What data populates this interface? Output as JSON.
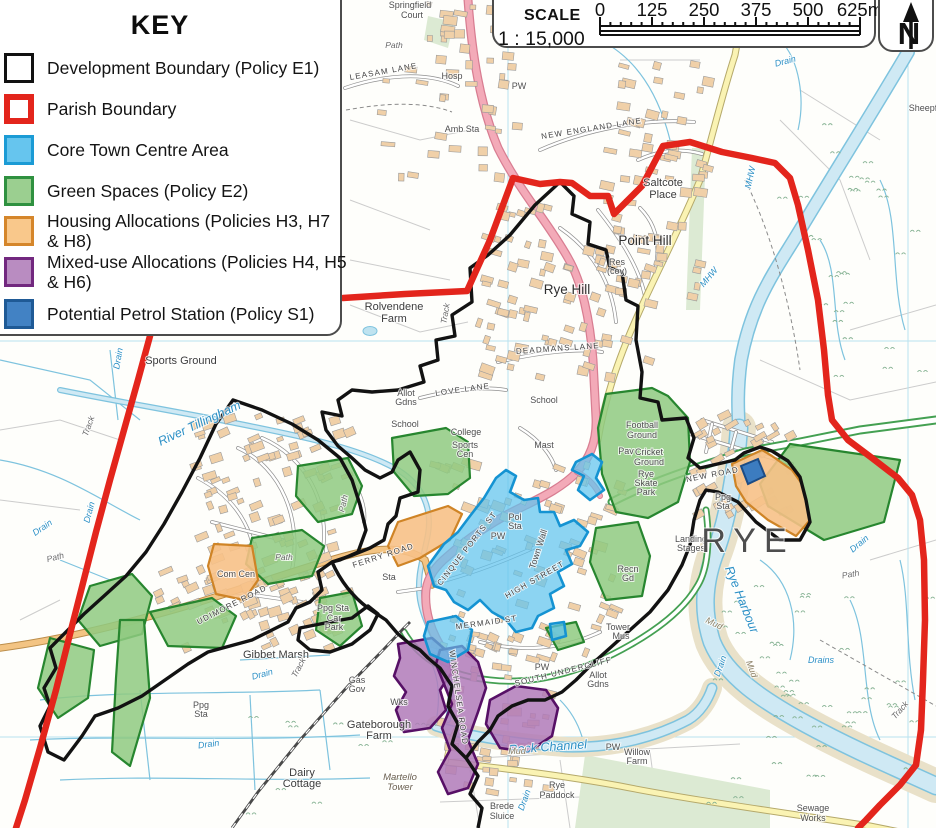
{
  "legend": {
    "title": "KEY",
    "items": [
      {
        "label": "Development Boundary (Policy E1)",
        "fill": "#ffffff",
        "stroke": "#111111",
        "border": 3
      },
      {
        "label": "Parish Boundary",
        "fill": "#ffffff",
        "stroke": "#e3251c",
        "border": 6
      },
      {
        "label": "Core Town Centre Area",
        "fill": "#66c5ee",
        "stroke": "#1b9bd5",
        "border": 3
      },
      {
        "label": "Green Spaces (Policy E2)",
        "fill": "#9bcf90",
        "stroke": "#2f9140",
        "border": 3
      },
      {
        "label": "Housing Allocations (Policies H3, H7\n& H8)",
        "fill": "#f9c88b",
        "stroke": "#d5862b",
        "border": 3
      },
      {
        "label": "Mixed-use Allocations (Policies H4, H5\n& H6)",
        "fill": "#b98cc1",
        "stroke": "#72287f",
        "border": 3
      },
      {
        "label": "Potential Petrol Station (Policy S1)",
        "fill": "#4282c4",
        "stroke": "#1f5a96",
        "border": 3
      }
    ]
  },
  "scale": {
    "label": "SCALE",
    "ratio": "1 : 15,000",
    "unit_labels": [
      "0",
      "125",
      "250",
      "375",
      "500",
      "625m"
    ]
  },
  "north": {
    "label": "N"
  },
  "colors": {
    "development_boundary": "#121212",
    "parish_boundary": "#e3251c",
    "core_town_fill": "#5fc3ef",
    "core_town_stroke": "#1593d2",
    "green_fill": "#8fca80",
    "green_stroke": "#27862f",
    "housing_fill": "#f7c187",
    "housing_stroke": "#cf8426",
    "mixed_fill": "#b07ab8",
    "mixed_stroke": "#571066",
    "petrol_fill": "#3c7cc0",
    "petrol_stroke": "#1c4c85",
    "road_primary": "#f3aab8",
    "road_primary_casing": "#d87d91",
    "road_a": "#f3c483",
    "road_a_casing": "#bb8d4a",
    "road_yellow": "#faf3b3",
    "road_yellow_casing": "#b5a96b",
    "road_minor_casing": "#8f8f8f",
    "water_line": "#7ec3de",
    "water_fill": "#cfe9f4",
    "mud": "#e9e1c9",
    "building_fill": "#f0d0a8",
    "building_stroke": "#9b9b9b",
    "grid_line": "#b8e2ef",
    "field_line": "#cccccc",
    "green_tint": "#dcead3"
  },
  "map_labels": [
    {
      "t": "Springfield",
      "x": 410,
      "y": 8,
      "c": "s"
    },
    {
      "t": "Court",
      "x": 412,
      "y": 18,
      "c": "s"
    },
    {
      "t": "Path",
      "x": 394,
      "y": 48,
      "c": "pa"
    },
    {
      "t": "LEASAM LANE",
      "x": 384,
      "y": 74,
      "c": "rd",
      "r": -10
    },
    {
      "t": "Hosp",
      "x": 452,
      "y": 79,
      "c": "s"
    },
    {
      "t": "PW",
      "x": 519,
      "y": 89,
      "c": "s"
    },
    {
      "t": "Amb Sta",
      "x": 462,
      "y": 132,
      "c": "s"
    },
    {
      "t": "NEW ENGLAND LANE",
      "x": 592,
      "y": 131,
      "c": "rd",
      "r": -9
    },
    {
      "t": "Drain",
      "x": 786,
      "y": 64,
      "c": "w",
      "r": -15
    },
    {
      "t": "Sheepfold",
      "x": 929,
      "y": 111,
      "c": "s"
    },
    {
      "t": "MHW",
      "x": 753,
      "y": 178,
      "c": "w",
      "r": -78
    },
    {
      "t": "Saltcote",
      "x": 663,
      "y": 186,
      "c": "p"
    },
    {
      "t": "Place",
      "x": 663,
      "y": 198,
      "c": "p"
    },
    {
      "t": "Point Hill",
      "x": 645,
      "y": 245,
      "c": "p13"
    },
    {
      "t": "Res",
      "x": 617,
      "y": 265,
      "c": "s"
    },
    {
      "t": "(cov)",
      "x": 617,
      "y": 274,
      "c": "s"
    },
    {
      "t": "MHW",
      "x": 711,
      "y": 279,
      "c": "w",
      "r": -50
    },
    {
      "t": "Rye Hill",
      "x": 567,
      "y": 294,
      "c": "p13"
    },
    {
      "t": "Rolvendene",
      "x": 394,
      "y": 310,
      "c": "p"
    },
    {
      "t": "Farm",
      "x": 394,
      "y": 322,
      "c": "p"
    },
    {
      "t": "Track",
      "x": 448,
      "y": 314,
      "c": "pa",
      "r": -80
    },
    {
      "t": "DEADMANS LANE",
      "x": 558,
      "y": 351,
      "c": "rd",
      "r": -4
    },
    {
      "t": "Sports Ground",
      "x": 181,
      "y": 364,
      "c": "p"
    },
    {
      "t": "Drain",
      "x": 121,
      "y": 359,
      "c": "w",
      "r": -80
    },
    {
      "t": "Track",
      "x": 91,
      "y": 427,
      "c": "pa",
      "r": -70
    },
    {
      "t": "River Tillingham",
      "x": 201,
      "y": 427,
      "c": "wlg",
      "r": -25
    },
    {
      "t": "Allot",
      "x": 406,
      "y": 396,
      "c": "s"
    },
    {
      "t": "Gdns",
      "x": 406,
      "y": 405,
      "c": "s"
    },
    {
      "t": "LOVE LANE",
      "x": 463,
      "y": 392,
      "c": "rd",
      "r": -8
    },
    {
      "t": "School",
      "x": 405,
      "y": 427,
      "c": "s"
    },
    {
      "t": "School",
      "x": 544,
      "y": 403,
      "c": "s"
    },
    {
      "t": "College",
      "x": 466,
      "y": 435,
      "c": "s"
    },
    {
      "t": "Sports",
      "x": 465,
      "y": 448,
      "c": "s"
    },
    {
      "t": "Cen",
      "x": 465,
      "y": 457,
      "c": "s"
    },
    {
      "t": "Mast",
      "x": 544,
      "y": 448,
      "c": "s"
    },
    {
      "t": "Football",
      "x": 642,
      "y": 428,
      "c": "s"
    },
    {
      "t": "Ground",
      "x": 642,
      "y": 438,
      "c": "s"
    },
    {
      "t": "Pav",
      "x": 626,
      "y": 454,
      "c": "s"
    },
    {
      "t": "Cricket",
      "x": 649,
      "y": 455,
      "c": "s"
    },
    {
      "t": "Ground",
      "x": 649,
      "y": 465,
      "c": "s"
    },
    {
      "t": "Rye",
      "x": 646,
      "y": 477,
      "c": "s"
    },
    {
      "t": "Skate",
      "x": 646,
      "y": 486,
      "c": "s"
    },
    {
      "t": "Park",
      "x": 646,
      "y": 495,
      "c": "s"
    },
    {
      "t": "Drain",
      "x": 92,
      "y": 513,
      "c": "w",
      "r": -75
    },
    {
      "t": "Drain",
      "x": 44,
      "y": 530,
      "c": "w",
      "r": -35
    },
    {
      "t": "Path",
      "x": 56,
      "y": 560,
      "c": "pa",
      "r": -15
    },
    {
      "t": "Pol",
      "x": 515,
      "y": 520,
      "c": "s"
    },
    {
      "t": "Sta",
      "x": 515,
      "y": 529,
      "c": "s"
    },
    {
      "t": "PW",
      "x": 498,
      "y": 539,
      "c": "s"
    },
    {
      "t": "Town Wall",
      "x": 541,
      "y": 550,
      "c": "s",
      "r": -72
    },
    {
      "t": "Ppg",
      "x": 723,
      "y": 500,
      "c": "s"
    },
    {
      "t": "Sta",
      "x": 723,
      "y": 509,
      "c": "s"
    },
    {
      "t": "NEW ROAD",
      "x": 713,
      "y": 477,
      "c": "rd",
      "r": -11
    },
    {
      "t": "Landing",
      "x": 691,
      "y": 542,
      "c": "s"
    },
    {
      "t": "Stages",
      "x": 691,
      "y": 551,
      "c": "s"
    },
    {
      "t": "Recn",
      "x": 628,
      "y": 572,
      "c": "s"
    },
    {
      "t": "Gd",
      "x": 628,
      "y": 581,
      "c": "s"
    },
    {
      "t": "RYE",
      "x": 748,
      "y": 552,
      "c": "town"
    },
    {
      "t": "Rye Harbour",
      "x": 738,
      "y": 601,
      "c": "wlg",
      "r": 68
    },
    {
      "t": "Path",
      "x": 851,
      "y": 577,
      "c": "pa",
      "r": -10
    },
    {
      "t": "Drain",
      "x": 861,
      "y": 546,
      "c": "w",
      "r": -40
    },
    {
      "t": "HIGH STREET",
      "x": 536,
      "y": 582,
      "c": "rd",
      "r": -30
    },
    {
      "t": "CINQUE PORTS ST",
      "x": 469,
      "y": 550,
      "c": "rd",
      "r": -52
    },
    {
      "t": "FERRY ROAD",
      "x": 384,
      "y": 558,
      "c": "rd",
      "r": -18
    },
    {
      "t": "Sta",
      "x": 389,
      "y": 580,
      "c": "s"
    },
    {
      "t": "Com Cen",
      "x": 236,
      "y": 577,
      "c": "s"
    },
    {
      "t": "Path",
      "x": 284,
      "y": 560,
      "c": "pa"
    },
    {
      "t": "Path",
      "x": 346,
      "y": 504,
      "c": "pa",
      "r": -78
    },
    {
      "t": "UDIMORE ROAD",
      "x": 233,
      "y": 607,
      "c": "rd",
      "r": -27
    },
    {
      "t": "Ppg Sta",
      "x": 333,
      "y": 611,
      "c": "s"
    },
    {
      "t": "Car",
      "x": 334,
      "y": 621,
      "c": "s"
    },
    {
      "t": "Park",
      "x": 334,
      "y": 630,
      "c": "s"
    },
    {
      "t": "MERMAID ST",
      "x": 487,
      "y": 625,
      "c": "rd",
      "r": -8
    },
    {
      "t": "Tower",
      "x": 618,
      "y": 630,
      "c": "s"
    },
    {
      "t": "Mus",
      "x": 621,
      "y": 639,
      "c": "s"
    },
    {
      "t": "Allot",
      "x": 598,
      "y": 678,
      "c": "s"
    },
    {
      "t": "Gdns",
      "x": 598,
      "y": 687,
      "c": "s"
    },
    {
      "t": "SOUTH UNDERCLIFF",
      "x": 564,
      "y": 674,
      "c": "rd",
      "r": -14
    },
    {
      "t": "PW",
      "x": 542,
      "y": 670,
      "c": "s"
    },
    {
      "t": "WINCHELSEA ROAD",
      "x": 456,
      "y": 698,
      "c": "rd",
      "r": 82
    },
    {
      "t": "Gibbet Marsh",
      "x": 276,
      "y": 658,
      "c": "p"
    },
    {
      "t": "Track",
      "x": 301,
      "y": 669,
      "c": "pa",
      "r": -62
    },
    {
      "t": "Drain",
      "x": 263,
      "y": 677,
      "c": "w",
      "r": -15
    },
    {
      "t": "Ppg",
      "x": 201,
      "y": 708,
      "c": "s"
    },
    {
      "t": "Sta",
      "x": 201,
      "y": 717,
      "c": "s"
    },
    {
      "t": "Drain",
      "x": 209,
      "y": 747,
      "c": "w",
      "r": -8
    },
    {
      "t": "Gas",
      "x": 357,
      "y": 683,
      "c": "s"
    },
    {
      "t": "Gov",
      "x": 357,
      "y": 692,
      "c": "s"
    },
    {
      "t": "Wks",
      "x": 399,
      "y": 705,
      "c": "s"
    },
    {
      "t": "Gateborough",
      "x": 379,
      "y": 728,
      "c": "p"
    },
    {
      "t": "Farm",
      "x": 379,
      "y": 739,
      "c": "p"
    },
    {
      "t": "Dairy",
      "x": 302,
      "y": 776,
      "c": "p"
    },
    {
      "t": "Cottage",
      "x": 302,
      "y": 787,
      "c": "p"
    },
    {
      "t": "Martello",
      "x": 400,
      "y": 780,
      "c": "aq"
    },
    {
      "t": "Tower",
      "x": 400,
      "y": 790,
      "c": "aq"
    },
    {
      "t": "Rock Channel",
      "x": 548,
      "y": 751,
      "c": "wlg",
      "r": -4
    },
    {
      "t": "Mud",
      "x": 517,
      "y": 754,
      "c": "mud"
    },
    {
      "t": "Mud",
      "x": 749,
      "y": 670,
      "c": "mud",
      "r": 70
    },
    {
      "t": "Mud",
      "x": 713,
      "y": 626,
      "c": "mud",
      "r": 25
    },
    {
      "t": "Drain",
      "x": 723,
      "y": 667,
      "c": "w",
      "r": -70
    },
    {
      "t": "Drains",
      "x": 821,
      "y": 663,
      "c": "w"
    },
    {
      "t": "Track",
      "x": 902,
      "y": 712,
      "c": "pa",
      "r": -48
    },
    {
      "t": "PW",
      "x": 613,
      "y": 750,
      "c": "s"
    },
    {
      "t": "Willow",
      "x": 637,
      "y": 755,
      "c": "s"
    },
    {
      "t": "Farm",
      "x": 637,
      "y": 764,
      "c": "s"
    },
    {
      "t": "Rye",
      "x": 557,
      "y": 788,
      "c": "s"
    },
    {
      "t": "Paddock",
      "x": 557,
      "y": 798,
      "c": "s"
    },
    {
      "t": "Brede",
      "x": 502,
      "y": 809,
      "c": "s"
    },
    {
      "t": "Sluice",
      "x": 502,
      "y": 819,
      "c": "s"
    },
    {
      "t": "Drain",
      "x": 527,
      "y": 801,
      "c": "w",
      "r": -70
    },
    {
      "t": "Sewage",
      "x": 813,
      "y": 811,
      "c": "s"
    },
    {
      "t": "Works",
      "x": 813,
      "y": 821,
      "c": "s"
    }
  ]
}
